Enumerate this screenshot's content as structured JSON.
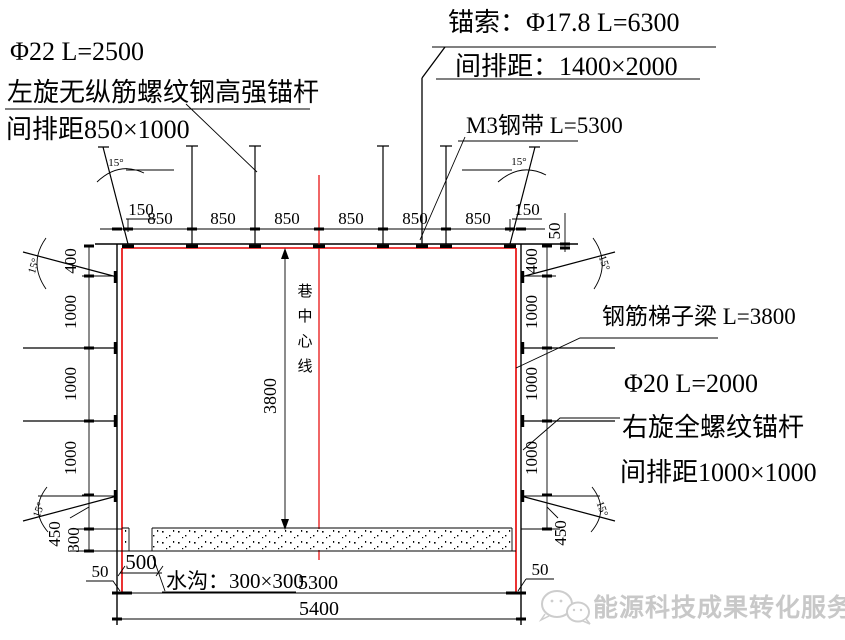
{
  "labels": {
    "left_bolt": {
      "spec": "Φ22  L=2500",
      "name": "左旋无纵筋螺纹钢高强锚杆",
      "spacing": "间排距850×1000"
    },
    "cable": {
      "spec": "锚索：Φ17.8  L=6300",
      "spacing": "间排距：1400×2000"
    },
    "steel_band": {
      "spec": "M3钢带 L=5300"
    },
    "ladder_beam": {
      "spec": "钢筋梯子梁 L=3800"
    },
    "right_bolt": {
      "spec": "Φ20 L=2000",
      "name": "右旋全螺纹锚杆",
      "spacing": "间排距1000×1000"
    },
    "ditch": {
      "label": "水沟：300×300"
    },
    "centerline_chars": [
      "巷",
      "中",
      "心",
      "线"
    ]
  },
  "dims": {
    "angle": "15°",
    "top": {
      "edge_left": "150",
      "bays": [
        "850",
        "850",
        "850",
        "850",
        "850",
        "850"
      ],
      "edge_right": "150",
      "offset_right": "50"
    },
    "left": {
      "segs": [
        "400",
        "1000",
        "1000",
        "1000",
        "450",
        "300"
      ],
      "offset_bottom": "50"
    },
    "right": {
      "segs": [
        "400",
        "1000",
        "1000",
        "1000",
        "450"
      ],
      "offset_bottom": "50"
    },
    "center_height": "3800",
    "ditch_offset": "500",
    "inner_width": "5300",
    "outer_width": "5400"
  },
  "watermark": {
    "text": "能源科技成果转化服务平台",
    "icon": "wechat-icon"
  },
  "colors": {
    "line": "#000000",
    "support": "#e60000",
    "watermark": "#c8c8c8"
  }
}
